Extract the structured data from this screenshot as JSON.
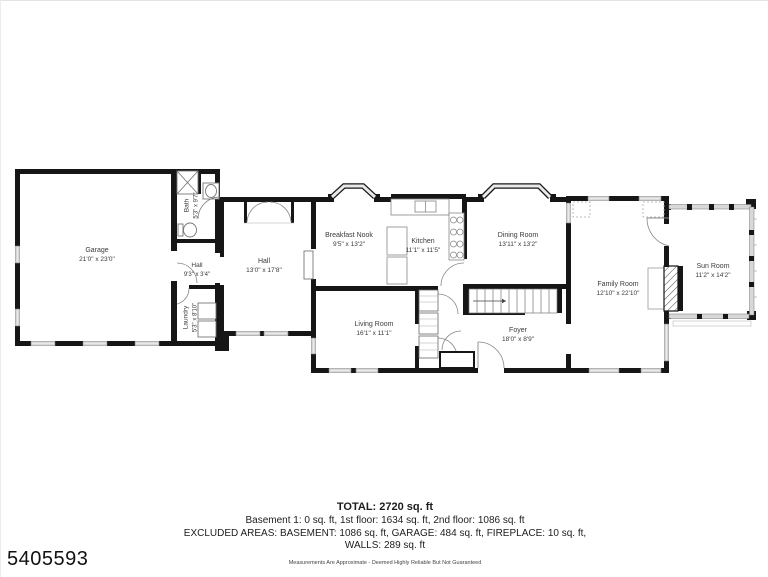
{
  "plan_id": "5405593",
  "rooms": [
    {
      "name": "Garage",
      "dims": "21'0\" x 23'0\""
    },
    {
      "name": "Bath",
      "dims": "5'3\" x 9'7\""
    },
    {
      "name": "Hall",
      "dims": "9'3\" x 3'4\""
    },
    {
      "name": "Laundry",
      "dims": "5'3\" x 8'10\""
    },
    {
      "name": "Hall",
      "dims": "13'0\" x 17'8\""
    },
    {
      "name": "Breakfast Nook",
      "dims": "9'5\" x 13'2\""
    },
    {
      "name": "Kitchen",
      "dims": "11'1\" x 11'5\""
    },
    {
      "name": "Dining Room",
      "dims": "13'11\" x 13'2\""
    },
    {
      "name": "Living Room",
      "dims": "16'1\" x 11'1\""
    },
    {
      "name": "Foyer",
      "dims": "18'0\" x 8'9\""
    },
    {
      "name": "Family Room",
      "dims": "12'10\" x 22'10\""
    },
    {
      "name": "Sun Room",
      "dims": "11'2\" x 14'2\""
    }
  ],
  "summary": {
    "total": "TOTAL: 2720 sq. ft",
    "line1": "Basement 1: 0 sq. ft, 1st floor: 1634 sq. ft, 2nd floor: 1086 sq. ft",
    "line2": "EXCLUDED AREAS: BASEMENT: 1086 sq. ft, GARAGE: 484 sq. ft, FIREPLACE: 10 sq. ft,",
    "line3": "WALLS: 289 sq. ft",
    "disclaimer": "Measurements Are Approximate - Deemed Highly Reliable But Not Guaranteed"
  },
  "colors": {
    "wall": "#161616",
    "window": "#e9e9e9",
    "text": "#3a3a3a"
  }
}
